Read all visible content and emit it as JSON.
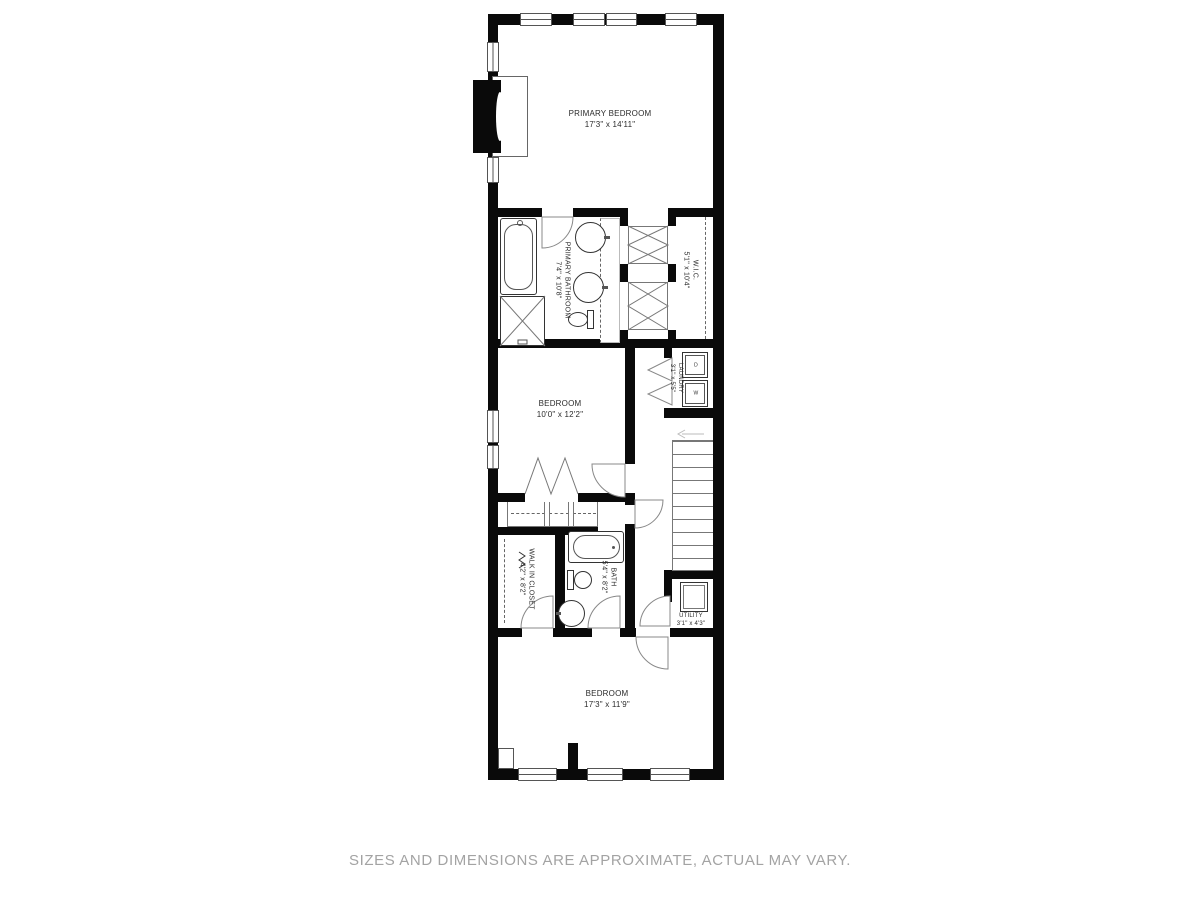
{
  "disclaimer": "SIZES AND DIMENSIONS ARE APPROXIMATE, ACTUAL MAY VARY.",
  "rooms": {
    "primary_bedroom": {
      "name": "PRIMARY BEDROOM",
      "dims": "17'3\" x 14'11\""
    },
    "primary_bathroom": {
      "name": "PRIMARY BATHROOM",
      "dims": "7'4\" x 10'8\""
    },
    "wic": {
      "name": "W.I.C.",
      "dims": "5'1\" x 10'4\""
    },
    "laundry": {
      "name": "LAUNDRY",
      "dims": "3'1\" x 5'5\""
    },
    "bedroom_mid": {
      "name": "BEDROOM",
      "dims": "10'0\" x 12'2\""
    },
    "walk_in_closet": {
      "name": "WALK IN CLOSET",
      "dims": "4'2\" x 8'2\""
    },
    "bath": {
      "name": "BATH",
      "dims": "5'4\" x 8'2\""
    },
    "utility": {
      "name": "UTILITY",
      "dims": "3'1\" x 4'3\""
    },
    "bedroom_bottom": {
      "name": "BEDROOM",
      "dims": "17'3\" x 11'9\""
    }
  },
  "appliances": {
    "washer": "W",
    "dryer": "D"
  },
  "colors": {
    "wall": "#0a0a0a",
    "line": "#555555",
    "disclaimer": "#a3a3a3",
    "background": "#ffffff"
  }
}
